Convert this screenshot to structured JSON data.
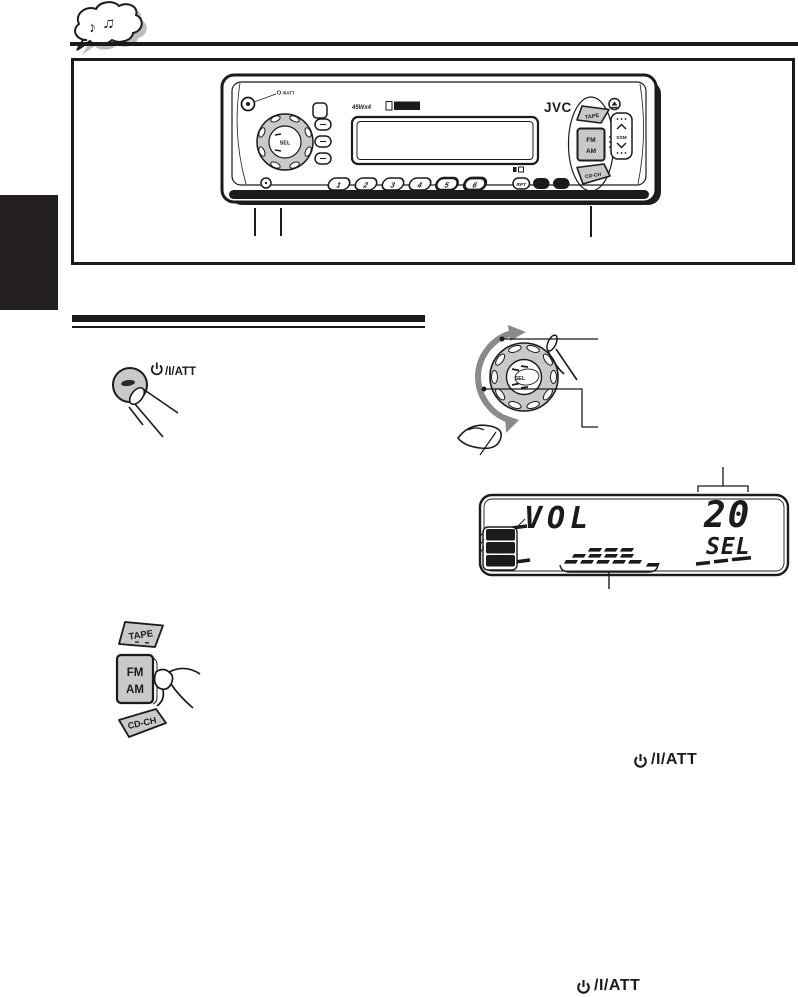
{
  "icons": {
    "note1": "♪",
    "note2": "♫"
  },
  "labels": {
    "att": "/I/ATT",
    "att_full": "⏻/I/ATT"
  },
  "unit": {
    "brand": "JVC",
    "amp": "45Wx4",
    "sel": "SEL",
    "presets": [
      "1",
      "2",
      "3",
      "4",
      "5",
      "6"
    ],
    "modes": [
      "RPT",
      "RND",
      "SCM"
    ],
    "tape": "TAPE",
    "fm": "FM",
    "am": "AM",
    "cdch": "CD-CH",
    "ssm": "SSM"
  },
  "display": {
    "vol": "VOL",
    "value": "20",
    "sel": "SEL",
    "modes": [
      "BEAT",
      "SOFT",
      "POP"
    ]
  }
}
